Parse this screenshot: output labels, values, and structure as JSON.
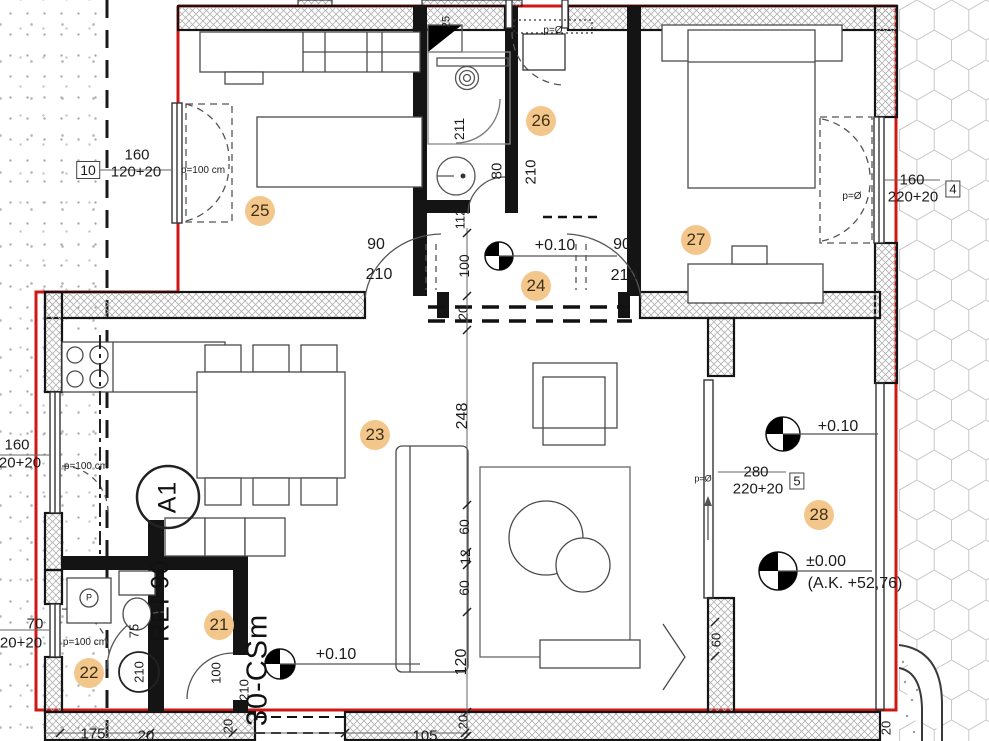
{
  "drawing_kind": "apartment-floor-plan",
  "colors": {
    "boundary_red": "#cf1715",
    "badge_bg": "#f3c78b",
    "wall_line": "#141414",
    "hatch_line": "#b0b0b0"
  },
  "rooms": [
    {
      "number": "21",
      "x": 219,
      "y": 625
    },
    {
      "number": "22",
      "x": 89,
      "y": 673
    },
    {
      "number": "23",
      "x": 375,
      "y": 435
    },
    {
      "number": "24",
      "x": 536,
      "y": 286
    },
    {
      "number": "25",
      "x": 260,
      "y": 211
    },
    {
      "number": "26",
      "x": 541,
      "y": 121
    },
    {
      "number": "27",
      "x": 696,
      "y": 240
    },
    {
      "number": "28",
      "x": 819,
      "y": 515
    }
  ],
  "labels": [
    {
      "t": "10",
      "x": 88,
      "y": 170,
      "s": 14,
      "cls": "boxed"
    },
    {
      "t": "160",
      "x": 137,
      "y": 155,
      "s": 15
    },
    {
      "t": "120+20",
      "x": 136,
      "y": 172,
      "s": 15
    },
    {
      "t": "p=100 cm",
      "x": 203,
      "y": 171,
      "s": 10
    },
    {
      "t": "211",
      "x": 459,
      "y": 129,
      "s": 14,
      "rot": 1
    },
    {
      "t": "25",
      "x": 447,
      "y": 22,
      "s": 11,
      "rot": 1
    },
    {
      "t": "p=Ø",
      "x": 553,
      "y": 31,
      "s": 10
    },
    {
      "t": "80",
      "x": 497,
      "y": 171,
      "s": 15,
      "rot": 1
    },
    {
      "t": "210",
      "x": 531,
      "y": 172,
      "s": 15,
      "rot": 1
    },
    {
      "t": "112",
      "x": 460,
      "y": 219,
      "s": 13,
      "rot": 1
    },
    {
      "t": "160",
      "x": 912,
      "y": 180,
      "s": 15
    },
    {
      "t": "220+20",
      "x": 913,
      "y": 197,
      "s": 15
    },
    {
      "t": "4",
      "x": 953,
      "y": 189,
      "s": 13,
      "cls": "boxed"
    },
    {
      "t": "p=Ø",
      "x": 852,
      "y": 197,
      "s": 10
    },
    {
      "t": "90",
      "x": 376,
      "y": 245,
      "s": 16
    },
    {
      "t": "210",
      "x": 379,
      "y": 275,
      "s": 16
    },
    {
      "t": "+0.10",
      "x": 555,
      "y": 246,
      "s": 16
    },
    {
      "t": "90",
      "x": 622,
      "y": 245,
      "s": 16
    },
    {
      "t": "210",
      "x": 624,
      "y": 276,
      "s": 16
    },
    {
      "t": "100",
      "x": 464,
      "y": 266,
      "s": 14,
      "rot": 1
    },
    {
      "t": "20",
      "x": 463,
      "y": 313,
      "s": 13,
      "rot": 1
    },
    {
      "t": "248",
      "x": 463,
      "y": 416,
      "s": 16,
      "rot": 1
    },
    {
      "t": "60",
      "x": 464,
      "y": 527,
      "s": 14,
      "rot": 1
    },
    {
      "t": "12",
      "x": 465,
      "y": 557,
      "s": 14,
      "rot": 1
    },
    {
      "t": "60",
      "x": 464,
      "y": 588,
      "s": 14,
      "rot": 1
    },
    {
      "t": "120",
      "x": 462,
      "y": 662,
      "s": 16,
      "rot": 1
    },
    {
      "t": "20",
      "x": 463,
      "y": 722,
      "s": 13,
      "rot": 1
    },
    {
      "t": "60",
      "x": 716,
      "y": 640,
      "s": 13,
      "rot": 1
    },
    {
      "t": "160",
      "x": 17,
      "y": 445,
      "s": 15
    },
    {
      "t": "20+20",
      "x": 20,
      "y": 463,
      "s": 15
    },
    {
      "t": "p=100 cm",
      "x": 86,
      "y": 467,
      "s": 10
    },
    {
      "t": "70",
      "x": 35,
      "y": 624,
      "s": 15
    },
    {
      "t": "20+20",
      "x": 21,
      "y": 643,
      "s": 15
    },
    {
      "t": "p=100 cm",
      "x": 85,
      "y": 643,
      "s": 10
    },
    {
      "t": "+0.10",
      "x": 336,
      "y": 655,
      "s": 16
    },
    {
      "t": "75",
      "x": 134,
      "y": 631,
      "s": 13,
      "rot": 1
    },
    {
      "t": "210",
      "x": 139,
      "y": 672,
      "s": 13,
      "rot": 1
    },
    {
      "t": "100",
      "x": 216,
      "y": 673,
      "s": 13,
      "rot": 1
    },
    {
      "t": "210",
      "x": 244,
      "y": 690,
      "s": 13,
      "rot": 1
    },
    {
      "t": "REI 90-",
      "x": 161,
      "y": 596,
      "s": 25,
      "rot": 1,
      "cls": "big"
    },
    {
      "t": "A1",
      "x": 168,
      "y": 497,
      "s": 25,
      "rot": 1,
      "cls": "big"
    },
    {
      "t": "30-CSm",
      "x": 258,
      "y": 670,
      "s": 29,
      "rot": 1,
      "cls": "big"
    },
    {
      "t": "+0.10",
      "x": 838,
      "y": 427,
      "s": 16
    },
    {
      "t": "280",
      "x": 756,
      "y": 472,
      "s": 15
    },
    {
      "t": "220+20",
      "x": 758,
      "y": 489,
      "s": 15
    },
    {
      "t": "5",
      "x": 797,
      "y": 481,
      "s": 13,
      "cls": "boxed"
    },
    {
      "t": "p=Ø",
      "x": 703,
      "y": 479,
      "s": 9
    },
    {
      "t": "±0.00",
      "x": 826,
      "y": 562,
      "s": 16
    },
    {
      "t": "(A.K. +52,76)",
      "x": 855,
      "y": 584,
      "s": 16
    },
    {
      "t": "175",
      "x": 93,
      "y": 734,
      "s": 15
    },
    {
      "t": "20",
      "x": 146,
      "y": 736,
      "s": 15
    },
    {
      "t": "105",
      "x": 425,
      "y": 736,
      "s": 15
    },
    {
      "t": "20",
      "x": 228,
      "y": 726,
      "s": 13,
      "rot": 1
    },
    {
      "t": "20",
      "x": 886,
      "y": 728,
      "s": 13,
      "rot": 1
    },
    {
      "t": "P",
      "x": 89,
      "y": 598,
      "s": 9
    }
  ]
}
